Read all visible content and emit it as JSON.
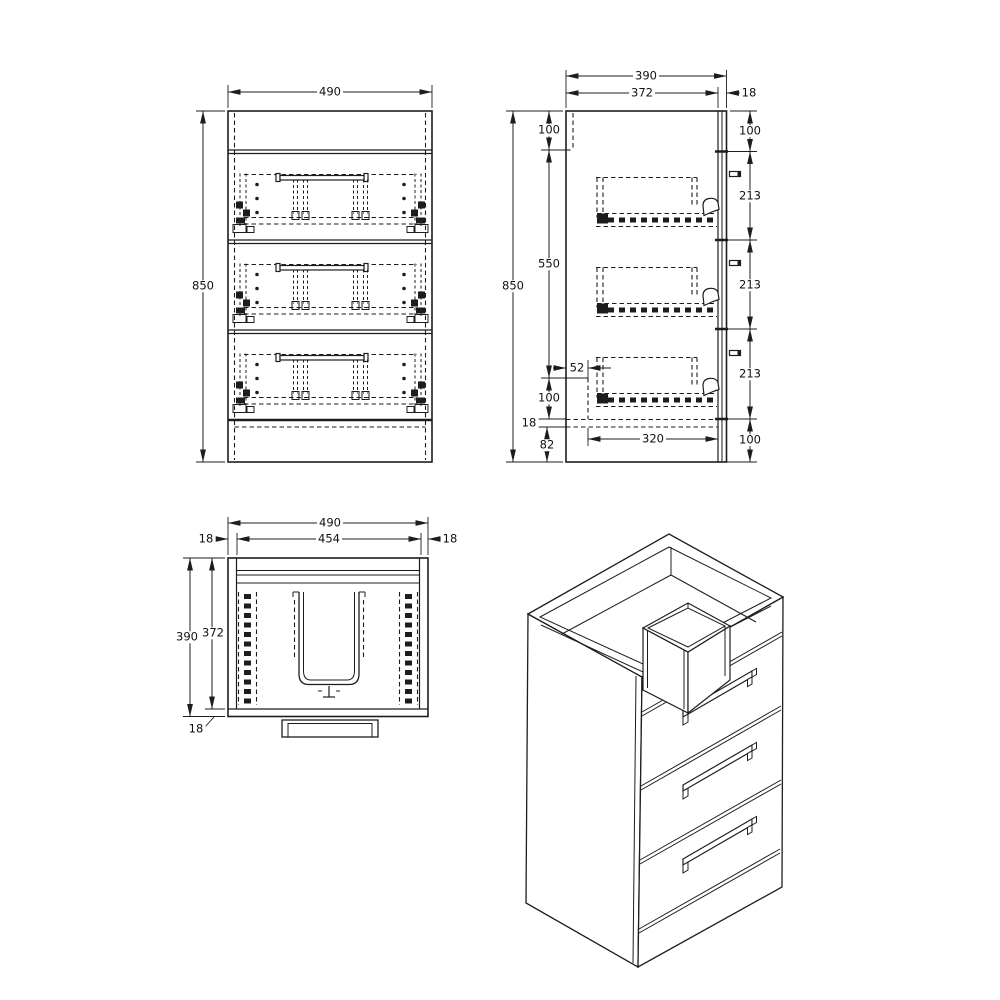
{
  "dims": {
    "front": {
      "width": "490",
      "height": "850"
    },
    "side": {
      "depth": "390",
      "carcass_depth": "372",
      "front_panel": "18",
      "height": "850",
      "back_rail": "100",
      "mid": "550",
      "drawer_offset": "52",
      "above_bottom": "100",
      "bottom_panel": "18",
      "plinth": "82",
      "runner": "320",
      "front_top_gap": "100",
      "drawers": [
        "213",
        "213",
        "213"
      ],
      "front_bottom_gap": "100"
    },
    "plan": {
      "width": "490",
      "inner_width": "454",
      "left_wall": "18",
      "right_wall": "18",
      "depth": "390",
      "carcass_depth": "372",
      "front_panel": "18"
    }
  }
}
